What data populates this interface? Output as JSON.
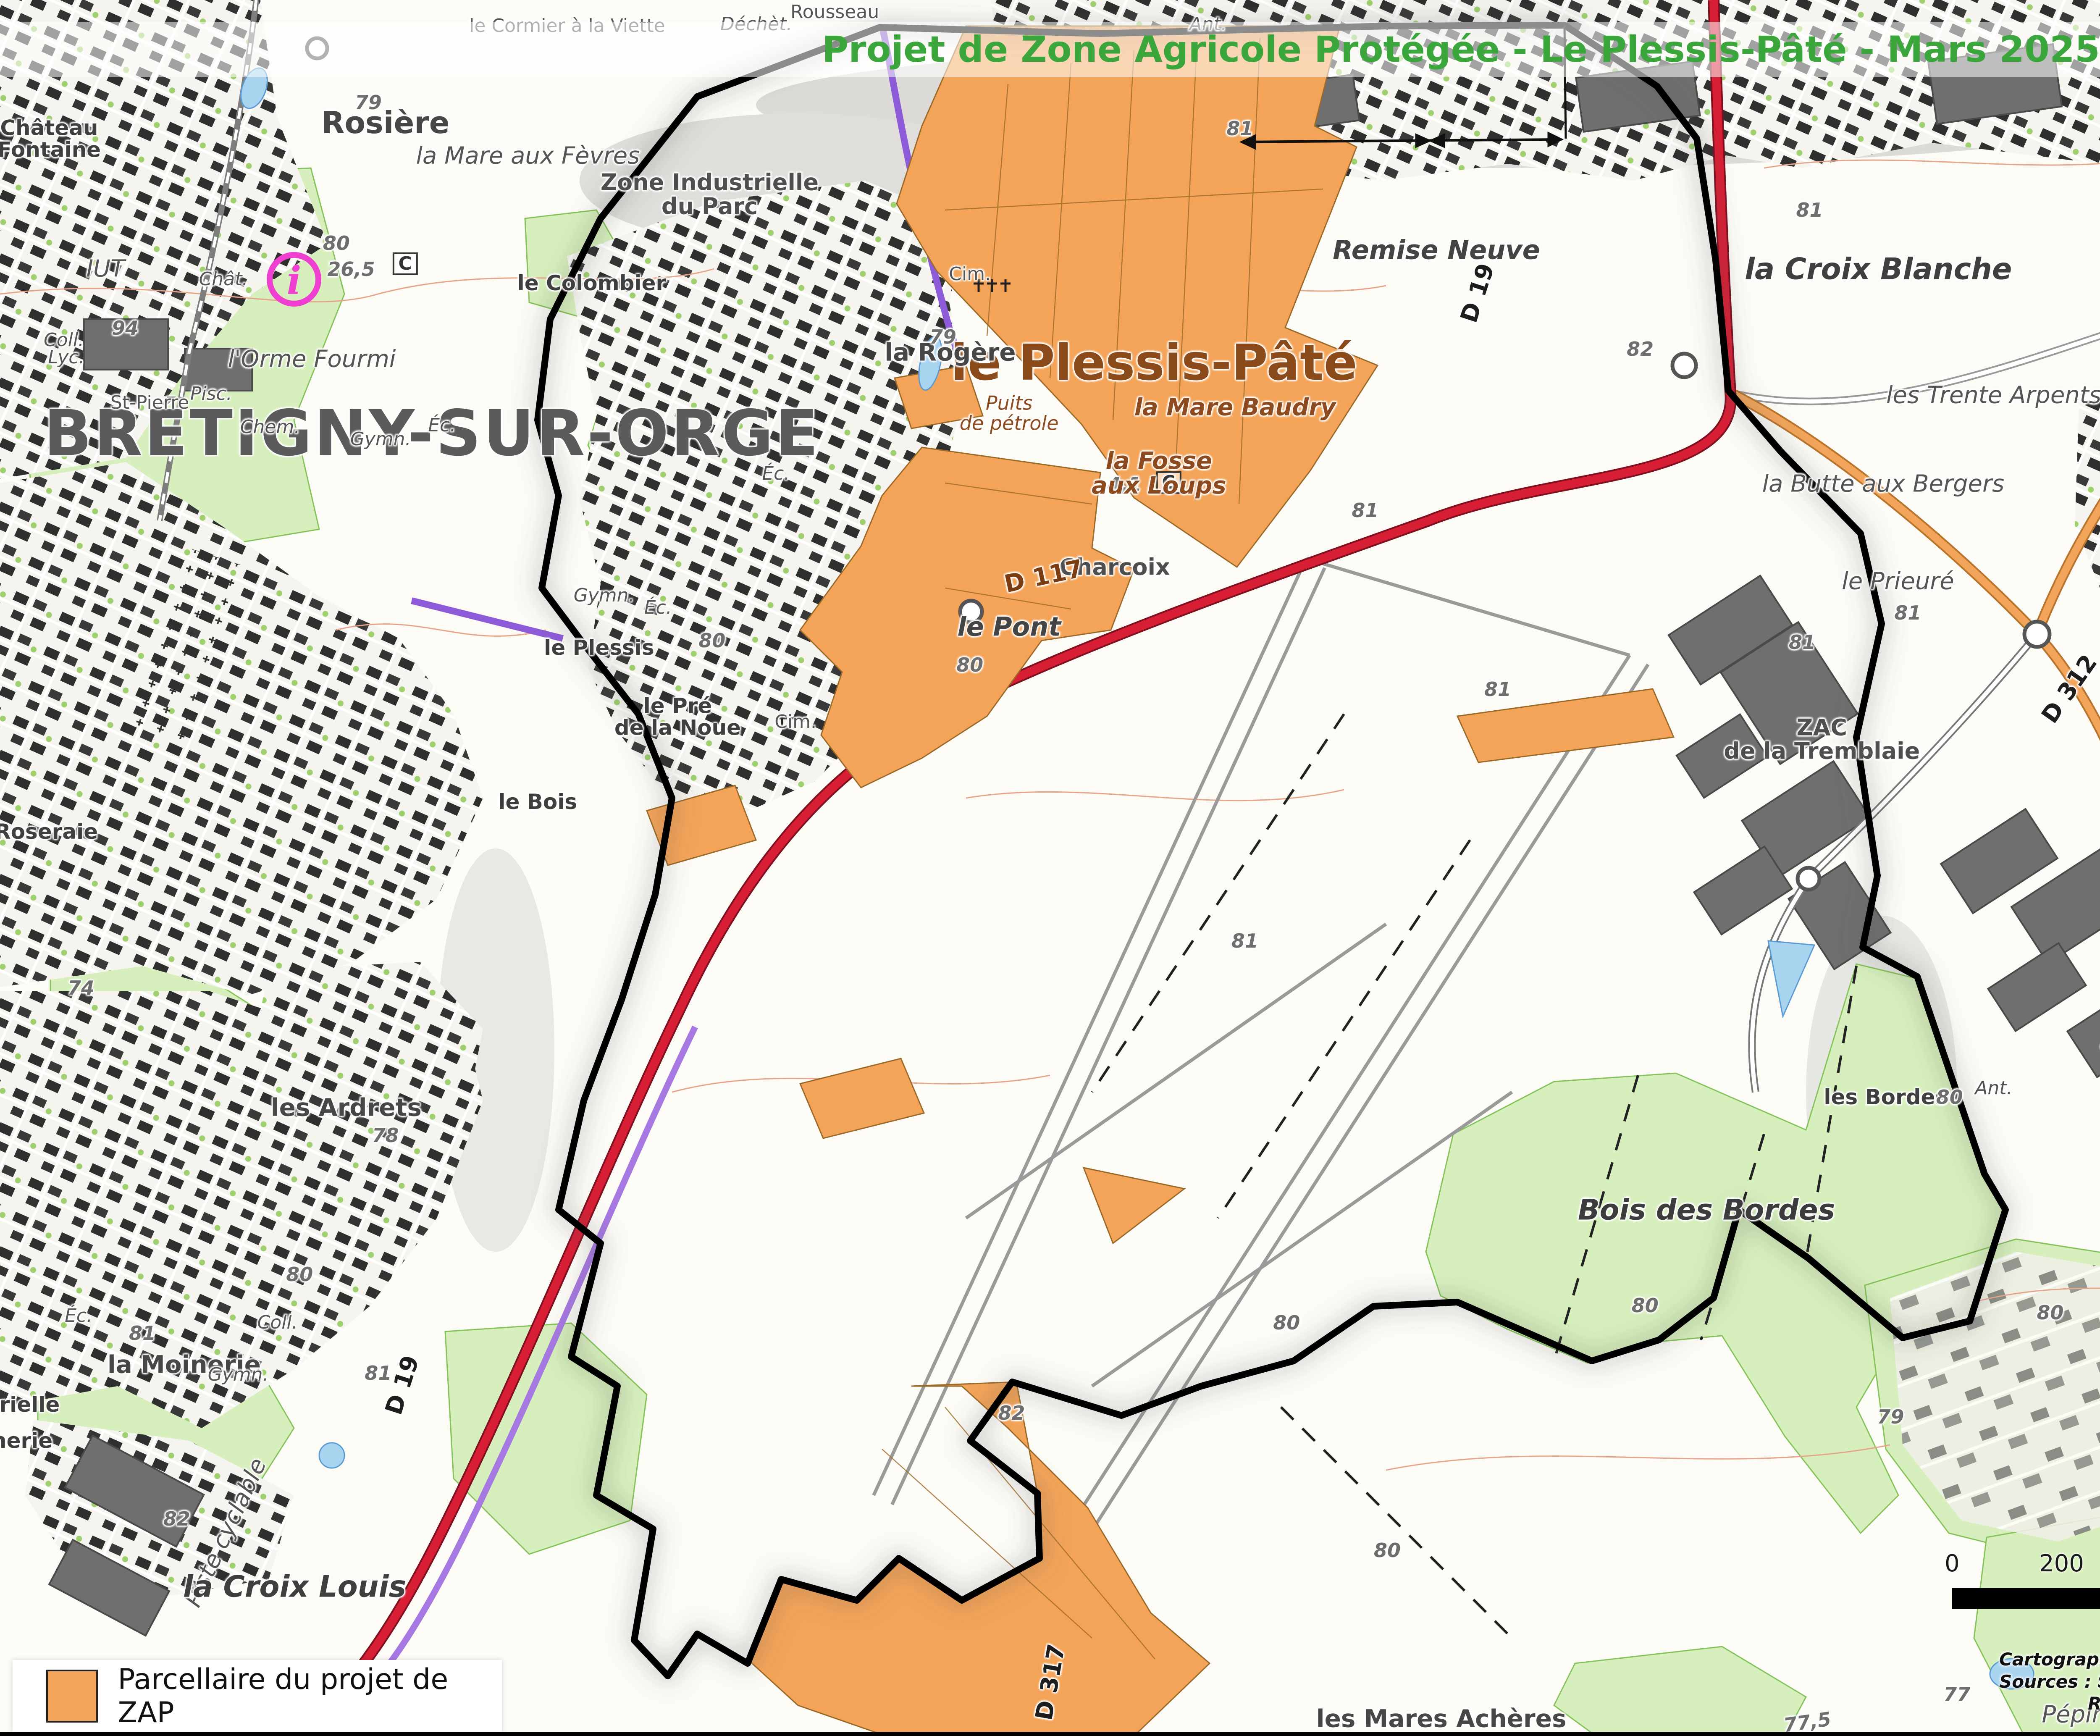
{
  "header": {
    "title": "Projet de Zone Agricole Protégée - Le Plessis-Pâté - Mars 2025"
  },
  "logo": {
    "brand": "safer",
    "tagline": "de l'Île-de-France"
  },
  "legend": {
    "items": [
      {
        "label": "Parcellaire du projet de ZAP",
        "swatch_color": "#f4a458"
      }
    ]
  },
  "scalebar": {
    "ticks": [
      "0",
      "200",
      "400 m"
    ]
  },
  "north": {
    "label": "N"
  },
  "credits": [
    "Cartographie : SAFER Île-de-France - Mars 2025",
    "Sources : SAFER Île-de-France, IGN, Géoportail de l'urbanisme (2024)",
    "REPRODUCTION INTERDITE"
  ],
  "colors": {
    "title-green": "#3aa63c",
    "logo-olive": "#8b9a33",
    "logo-orange": "#f29124",
    "zap-orange": "#f4a458",
    "road-red": "#d81e34",
    "road-orange": "#f2a55a",
    "road-purple": "#a678e2",
    "green-area": "#d6efbc",
    "brown-label": "#8c4a1e"
  },
  "map": {
    "labels": [
      {
        "t": "BRÉTIGNY-SUR-ORGE",
        "x": 17.6,
        "y": 25.0,
        "c": "city"
      },
      {
        "t": "le Plessis-Pâté",
        "x": 47.0,
        "y": 20.9,
        "c": "town"
      },
      {
        "t": "Rosière",
        "x": 15.7,
        "y": 7.1,
        "c": "hamlet"
      },
      {
        "t": "la Mare aux Fèvres",
        "x": 21.5,
        "y": 9.0,
        "c": "lieu"
      },
      {
        "t": "le Cormier à la Viette",
        "x": 23.1,
        "y": 1.5,
        "c": "small"
      },
      {
        "t": "Rousseau",
        "x": 34.0,
        "y": 0.7,
        "c": "small"
      },
      {
        "t": "Déchèt.",
        "x": 30.8,
        "y": 1.4,
        "c": "small-it"
      },
      {
        "t": "Ant.",
        "x": 49.2,
        "y": 1.4,
        "c": "small-it"
      },
      {
        "t": "Zone Industrielle\ndu Parc",
        "x": 28.9,
        "y": 11.2,
        "c": "zone"
      },
      {
        "t": "la Rogère",
        "x": 38.7,
        "y": 20.3,
        "c": "hamlet2"
      },
      {
        "t": "Cim.",
        "x": 39.5,
        "y": 15.8,
        "c": "small"
      },
      {
        "t": "Cim.",
        "x": 32.4,
        "y": 41.6,
        "c": "small"
      },
      {
        "t": "79",
        "x": 38.4,
        "y": 19.4,
        "c": "elev"
      },
      {
        "t": "4,1",
        "x": 45.8,
        "y": 27.9,
        "c": "elev"
      },
      {
        "t": "C",
        "x": 47.6,
        "y": 27.8,
        "c": "cbox"
      },
      {
        "t": "C",
        "x": 16.5,
        "y": 15.2,
        "c": "cbox"
      },
      {
        "t": "Puits\nde pétrole",
        "x": 41.1,
        "y": 23.8,
        "c": "brown-sm"
      },
      {
        "t": "la Fosse\naux Loups",
        "x": 47.2,
        "y": 27.3,
        "c": "brown"
      },
      {
        "t": "la Mare Baudry",
        "x": 50.3,
        "y": 23.5,
        "c": "brown"
      },
      {
        "t": "Remise Neuve",
        "x": 58.5,
        "y": 14.4,
        "c": "lieu-b"
      },
      {
        "t": "la Croix Blanche",
        "x": 76.5,
        "y": 15.5,
        "c": "lieu-xl"
      },
      {
        "t": "le Grand\nNoyer",
        "x": 92.0,
        "y": 18.0,
        "c": "lieu"
      },
      {
        "t": "les Trente Arpents",
        "x": 81.2,
        "y": 22.8,
        "c": "lieu"
      },
      {
        "t": "la Butte aux Bergers",
        "x": 76.7,
        "y": 27.9,
        "c": "lieu"
      },
      {
        "t": "le Prieuré",
        "x": 77.3,
        "y": 33.5,
        "c": "lieu"
      },
      {
        "t": "les Trois Parts",
        "x": 93.3,
        "y": 33.8,
        "c": "name50"
      },
      {
        "t": "Gymn.",
        "x": 95.5,
        "y": 27.4,
        "c": "small-it"
      },
      {
        "t": "Coll.",
        "x": 95.2,
        "y": 30.4,
        "c": "small-it"
      },
      {
        "t": "Éc.",
        "x": 99.4,
        "y": 31.6,
        "c": "small-it"
      },
      {
        "t": "ZAC\nde la Tremblaie",
        "x": 74.2,
        "y": 42.6,
        "c": "zone"
      },
      {
        "t": "D 312",
        "x": 84.3,
        "y": 39.7,
        "c": "route",
        "r": -55
      },
      {
        "t": "81",
        "x": 77.7,
        "y": 35.3,
        "c": "elev"
      },
      {
        "t": "82",
        "x": 66.8,
        "y": 20.1,
        "c": "elev"
      },
      {
        "t": "D 19",
        "x": 60.2,
        "y": 16.9,
        "c": "route",
        "r": -72
      },
      {
        "t": "Charcoix",
        "x": 45.4,
        "y": 32.7,
        "c": "zone"
      },
      {
        "t": "le Pont",
        "x": 41.1,
        "y": 36.1,
        "c": "lieu-b"
      },
      {
        "t": "D 117",
        "x": 42.5,
        "y": 33.2,
        "c": "route-brown",
        "r": -12
      },
      {
        "t": "80",
        "x": 29.0,
        "y": 36.9,
        "c": "elev"
      },
      {
        "t": "80",
        "x": 39.5,
        "y": 38.3,
        "c": "elev"
      },
      {
        "t": "le Plessis",
        "x": 24.4,
        "y": 37.3,
        "c": "name50"
      },
      {
        "t": "le Colombier",
        "x": 24.1,
        "y": 16.3,
        "c": "name50"
      },
      {
        "t": "l'Orme Fourmi",
        "x": 12.7,
        "y": 20.7,
        "c": "lieu"
      },
      {
        "t": "le Pré\nde la Noue",
        "x": 27.6,
        "y": 41.3,
        "c": "name50"
      },
      {
        "t": "le Bois",
        "x": 21.9,
        "y": 46.2,
        "c": "name50"
      },
      {
        "t": "Éc.",
        "x": 26.8,
        "y": 35.0,
        "c": "small-it"
      },
      {
        "t": "Éc.",
        "x": 31.6,
        "y": 27.3,
        "c": "small-it"
      },
      {
        "t": "Gymn.",
        "x": 24.6,
        "y": 34.3,
        "c": "small-it"
      },
      {
        "t": "IUT",
        "x": 4.3,
        "y": 15.5,
        "c": "lieu"
      },
      {
        "t": "Château\nFontaine",
        "x": 2.0,
        "y": 8.0,
        "c": "name50"
      },
      {
        "t": "Chât.",
        "x": 9.1,
        "y": 16.1,
        "c": "small-it"
      },
      {
        "t": "St-Pierre",
        "x": 6.1,
        "y": 23.2,
        "c": "small"
      },
      {
        "t": "Pisc.",
        "x": 8.6,
        "y": 22.7,
        "c": "small-it"
      },
      {
        "t": "Chem.",
        "x": 11.0,
        "y": 24.6,
        "c": "small-it"
      },
      {
        "t": "Lyc.",
        "x": 2.7,
        "y": 20.6,
        "c": "small-it"
      },
      {
        "t": "Coll.",
        "x": 2.6,
        "y": 19.6,
        "c": "small-it"
      },
      {
        "t": "Éc.",
        "x": 18.0,
        "y": 24.5,
        "c": "small-it"
      },
      {
        "t": "Gymn.",
        "x": 15.5,
        "y": 25.3,
        "c": "small-it"
      },
      {
        "t": "94",
        "x": 5.1,
        "y": 18.9,
        "c": "elev"
      },
      {
        "t": "79",
        "x": 15.0,
        "y": 5.9,
        "c": "elev"
      },
      {
        "t": "80",
        "x": 13.7,
        "y": 14.0,
        "c": "elev"
      },
      {
        "t": "26,5",
        "x": 14.3,
        "y": 15.5,
        "c": "elev"
      },
      {
        "t": "les Ardrets",
        "x": 14.1,
        "y": 63.8,
        "c": "hamlet2"
      },
      {
        "t": "78",
        "x": 15.7,
        "y": 65.4,
        "c": "elev"
      },
      {
        "t": "74",
        "x": 3.3,
        "y": 56.9,
        "c": "elev"
      },
      {
        "t": "la Roseraie",
        "x": 1.3,
        "y": 47.9,
        "c": "name50"
      },
      {
        "t": "la Moinerie",
        "x": 7.5,
        "y": 78.6,
        "c": "hamlet2"
      },
      {
        "t": "Éc.",
        "x": 3.2,
        "y": 75.8,
        "c": "small-it"
      },
      {
        "t": "Coll.",
        "x": 11.3,
        "y": 76.2,
        "c": "small-it"
      },
      {
        "t": "Gymn.",
        "x": 9.7,
        "y": 79.2,
        "c": "small-it"
      },
      {
        "t": "80",
        "x": 12.2,
        "y": 73.4,
        "c": "elev"
      },
      {
        "t": "81",
        "x": 5.8,
        "y": 76.8,
        "c": "elev"
      },
      {
        "t": "81",
        "x": 15.4,
        "y": 79.1,
        "c": "elev"
      },
      {
        "t": "82",
        "x": 7.2,
        "y": 87.5,
        "c": "elev"
      },
      {
        "t": "Piste cyclable",
        "x": 9.2,
        "y": 88.3,
        "c": "lieu",
        "r": -65
      },
      {
        "t": "D 19",
        "x": 16.4,
        "y": 79.8,
        "c": "route",
        "r": -72
      },
      {
        "t": "la Croix Louis",
        "x": 12.0,
        "y": 91.4,
        "c": "lieu-xl"
      },
      {
        "t": "trielle",
        "x": 1.0,
        "y": 80.9,
        "c": "name50"
      },
      {
        "t": "nerie",
        "x": 0.9,
        "y": 83.0,
        "c": "name50"
      },
      {
        "t": "D 317",
        "x": 42.8,
        "y": 96.9,
        "c": "route",
        "r": -80
      },
      {
        "t": "les Mares Achères",
        "x": 58.7,
        "y": 99.0,
        "c": "hamlet2"
      },
      {
        "t": "Pépinière",
        "x": 85.4,
        "y": 98.8,
        "c": "lieu"
      },
      {
        "t": "77",
        "x": 79.7,
        "y": 97.6,
        "c": "elev"
      },
      {
        "t": "77,5",
        "x": 73.6,
        "y": 99.2,
        "c": "elev",
        "r": -8
      },
      {
        "t": "Bois des Bordes",
        "x": 69.5,
        "y": 69.7,
        "c": "forest"
      },
      {
        "t": "les Bordes",
        "x": 76.8,
        "y": 63.2,
        "c": "name50"
      },
      {
        "t": "Zone d'Activités\ndes Bordes",
        "x": 91.3,
        "y": 54.1,
        "c": "zone"
      },
      {
        "t": "le Parc\nde Tréville",
        "x": 90.3,
        "y": 65.7,
        "c": "lieu"
      },
      {
        "t": "Sous l",
        "x": 99.3,
        "y": 62.2,
        "c": "lieu"
      },
      {
        "t": "D 31",
        "x": 93.2,
        "y": 76.7,
        "c": "route",
        "r": -80
      },
      {
        "t": "81",
        "x": 86.1,
        "y": 60.1,
        "c": "elev"
      },
      {
        "t": "80",
        "x": 83.5,
        "y": 75.6,
        "c": "elev"
      },
      {
        "t": "79",
        "x": 77.0,
        "y": 81.6,
        "c": "elev"
      },
      {
        "t": "82",
        "x": 41.2,
        "y": 81.4,
        "c": "elev"
      },
      {
        "t": "81",
        "x": 50.7,
        "y": 54.2,
        "c": "elev"
      },
      {
        "t": "81",
        "x": 55.6,
        "y": 29.4,
        "c": "elev"
      },
      {
        "t": "81",
        "x": 61.0,
        "y": 39.7,
        "c": "elev"
      },
      {
        "t": "81",
        "x": 73.4,
        "y": 37.0,
        "c": "elev"
      },
      {
        "t": "80",
        "x": 79.4,
        "y": 63.2,
        "c": "elev"
      },
      {
        "t": "Ant.",
        "x": 81.2,
        "y": 62.7,
        "c": "small-it"
      },
      {
        "t": "80",
        "x": 56.5,
        "y": 89.3,
        "c": "elev"
      },
      {
        "t": "80",
        "x": 52.4,
        "y": 76.2,
        "c": "elev"
      },
      {
        "t": "80",
        "x": 67.0,
        "y": 75.2,
        "c": "elev"
      },
      {
        "t": "81",
        "x": 50.5,
        "y": 7.4,
        "c": "elev"
      },
      {
        "t": "81",
        "x": 73.7,
        "y": 12.1,
        "c": "elev"
      }
    ]
  }
}
